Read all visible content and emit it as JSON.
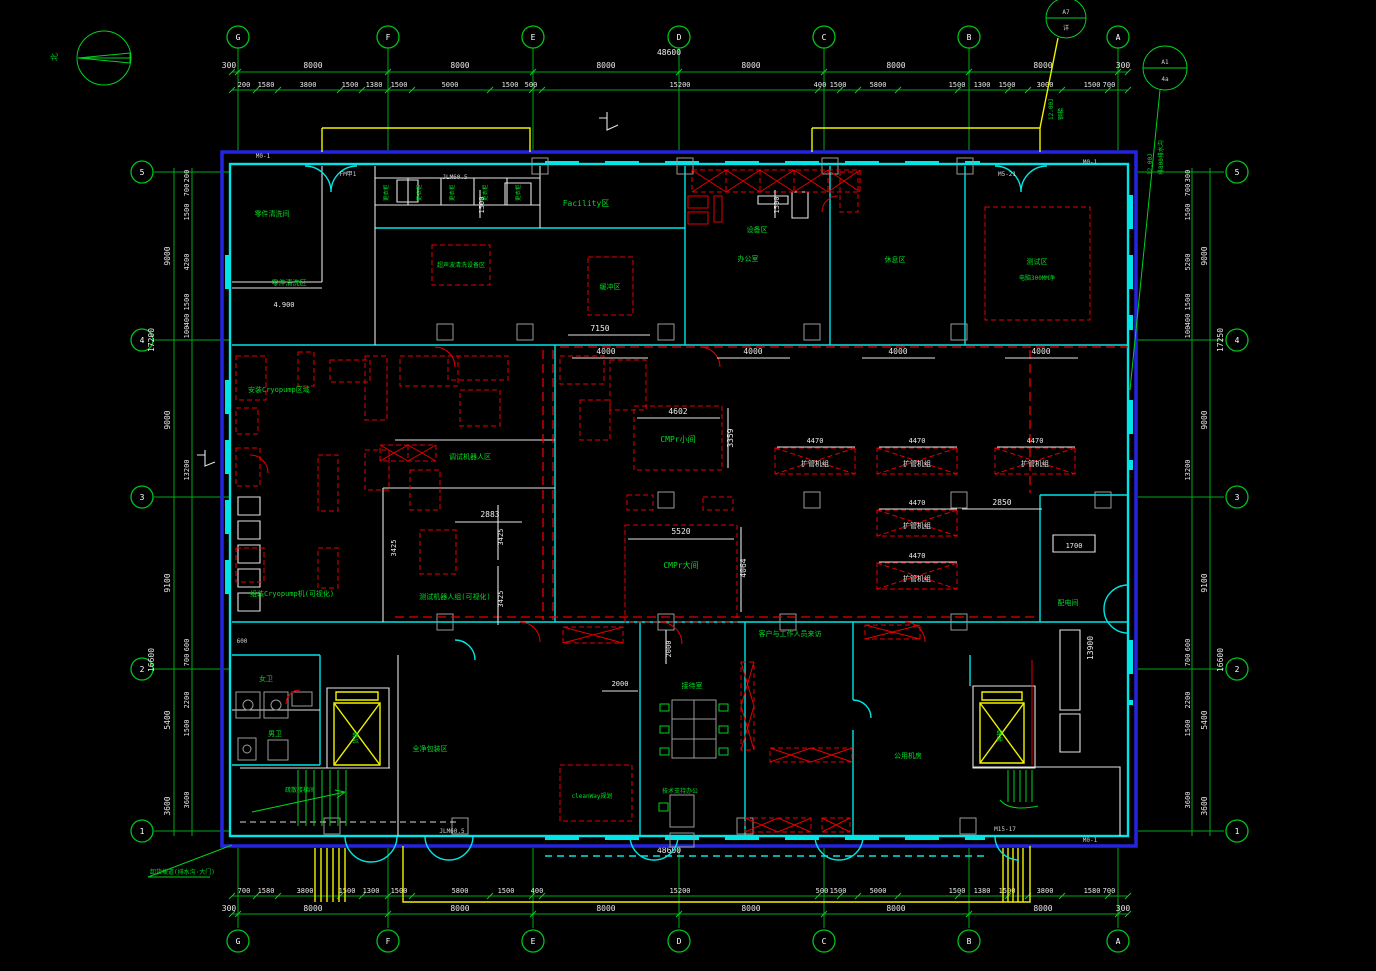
{
  "north_label": "北",
  "grid": {
    "cols": [
      "G",
      "F",
      "E",
      "D",
      "C",
      "B",
      "A"
    ],
    "rows": [
      "5",
      "4",
      "3",
      "2",
      "1"
    ]
  },
  "overall": {
    "top": "48600",
    "bottom": "48600"
  },
  "dims_top_main": [
    "300",
    "8000",
    "8000",
    "8000",
    "8000",
    "8000",
    "8000",
    "300"
  ],
  "dims_top_sub": [
    "200",
    "1580",
    "3800",
    "1500",
    "1380",
    "1500",
    "5000",
    "1500",
    "500",
    "15200",
    "400",
    "1500",
    "5800",
    "1500",
    "1300",
    "1500",
    "3000",
    "1500",
    "700"
  ],
  "dims_bottom_main": [
    "300",
    "8000",
    "8000",
    "8000",
    "8000",
    "8000",
    "8000",
    "300"
  ],
  "dims_bottom_sub": [
    "700",
    "1580",
    "3800",
    "1500",
    "1300",
    "1500",
    "5800",
    "1500",
    "400",
    "15200",
    "500",
    "1500",
    "5000",
    "1500",
    "1380",
    "1500",
    "3800",
    "1580",
    "700"
  ],
  "dims_left_main": [
    "9000",
    "9000",
    "9100",
    "5400",
    "3600"
  ],
  "dims_left_total": [
    "17200",
    "16600"
  ],
  "dims_left_sub": [
    "200",
    "700",
    "1500",
    "4200",
    "1500",
    "400",
    "100",
    "13200",
    "600",
    "700",
    "2200",
    "1500",
    "3600"
  ],
  "dims_right_main": [
    "9000",
    "9000",
    "9100",
    "5400",
    "3600"
  ],
  "dims_right_total": [
    "17250",
    "16600"
  ],
  "dims_right_sub": [
    "300",
    "700",
    "1500",
    "5200",
    "1500",
    "400",
    "100",
    "13200",
    "600",
    "700",
    "2200",
    "1500",
    "3600"
  ],
  "rooms": {
    "parts_wash_room": "零件清洗间",
    "parts_wash_area": "零件清洗区",
    "ultrasonic": "超声波清洗设备区",
    "facility": "Facility区",
    "buffer": "缓冲区",
    "equip_area": "设备区",
    "office": "办公室",
    "rest": "休息区",
    "test_room_l1": "测试区",
    "test_room_l2": "电脑300MM净",
    "cryo_install": "安装Cryopump区域",
    "cryo_assemble": "组装Cryopump机(可视化)",
    "robot_debug": "调试机器人区",
    "robot_test": "测试机器人组(可视化)",
    "cmpr_small": "CMPr小间",
    "cmpr_large": "CMPr大间",
    "power_room": "配电间",
    "wc_women": "女卫",
    "wc_men": "男卫",
    "freight_lift": "货梯",
    "stairs": "疏散楼梯间",
    "packing": "全净包装区",
    "cleanway": "cleanWay规划",
    "reception": "接待室",
    "tech_support": "技术支持办公",
    "visitor_corridor": "客户与工作人员来访",
    "utility_room": "公用机房",
    "passenger_lift": "客梯",
    "lockers": "更衣柜"
  },
  "lockers_row": [
    "更衣柜",
    "更衣柜",
    "更衣柜",
    "更衣柜",
    "更衣柜"
  ],
  "pipe_units": [
    "扩管机组",
    "扩管机组",
    "扩管机组",
    "扩管机组",
    "扩管机组"
  ],
  "dims_4470": [
    "4470",
    "4470",
    "4470",
    "4470",
    "4470"
  ],
  "dims_4000": [
    "4000",
    "4000",
    "4000",
    "4000"
  ],
  "dims_inline": {
    "w7150": "7150",
    "w4602": "4602",
    "w3359": "3359",
    "w5520": "5520",
    "w4064": "4064",
    "w2850": "2850",
    "w1700": "1700",
    "w13900": "13900",
    "w2883": "2883",
    "w3425": "3425",
    "w2000": "2000",
    "w1500": "1500",
    "w600": "600",
    "level": "4.900"
  },
  "door_tags": [
    "M0-1",
    "FM甲1",
    "JLM60.5",
    "M5-21",
    "M0-1",
    "JLM60.5",
    "M15-17",
    "M0-1"
  ],
  "callouts": [
    {
      "ref": "A7",
      "sheet": "详",
      "note1": "12.00J",
      "note2": "钢梯"
    },
    {
      "ref": "A1",
      "sheet": "4a",
      "note1": "12.00J",
      "note2": "排800排水沟"
    }
  ],
  "notes": {
    "unload": "卸货坡道(排水沟·大门)"
  }
}
